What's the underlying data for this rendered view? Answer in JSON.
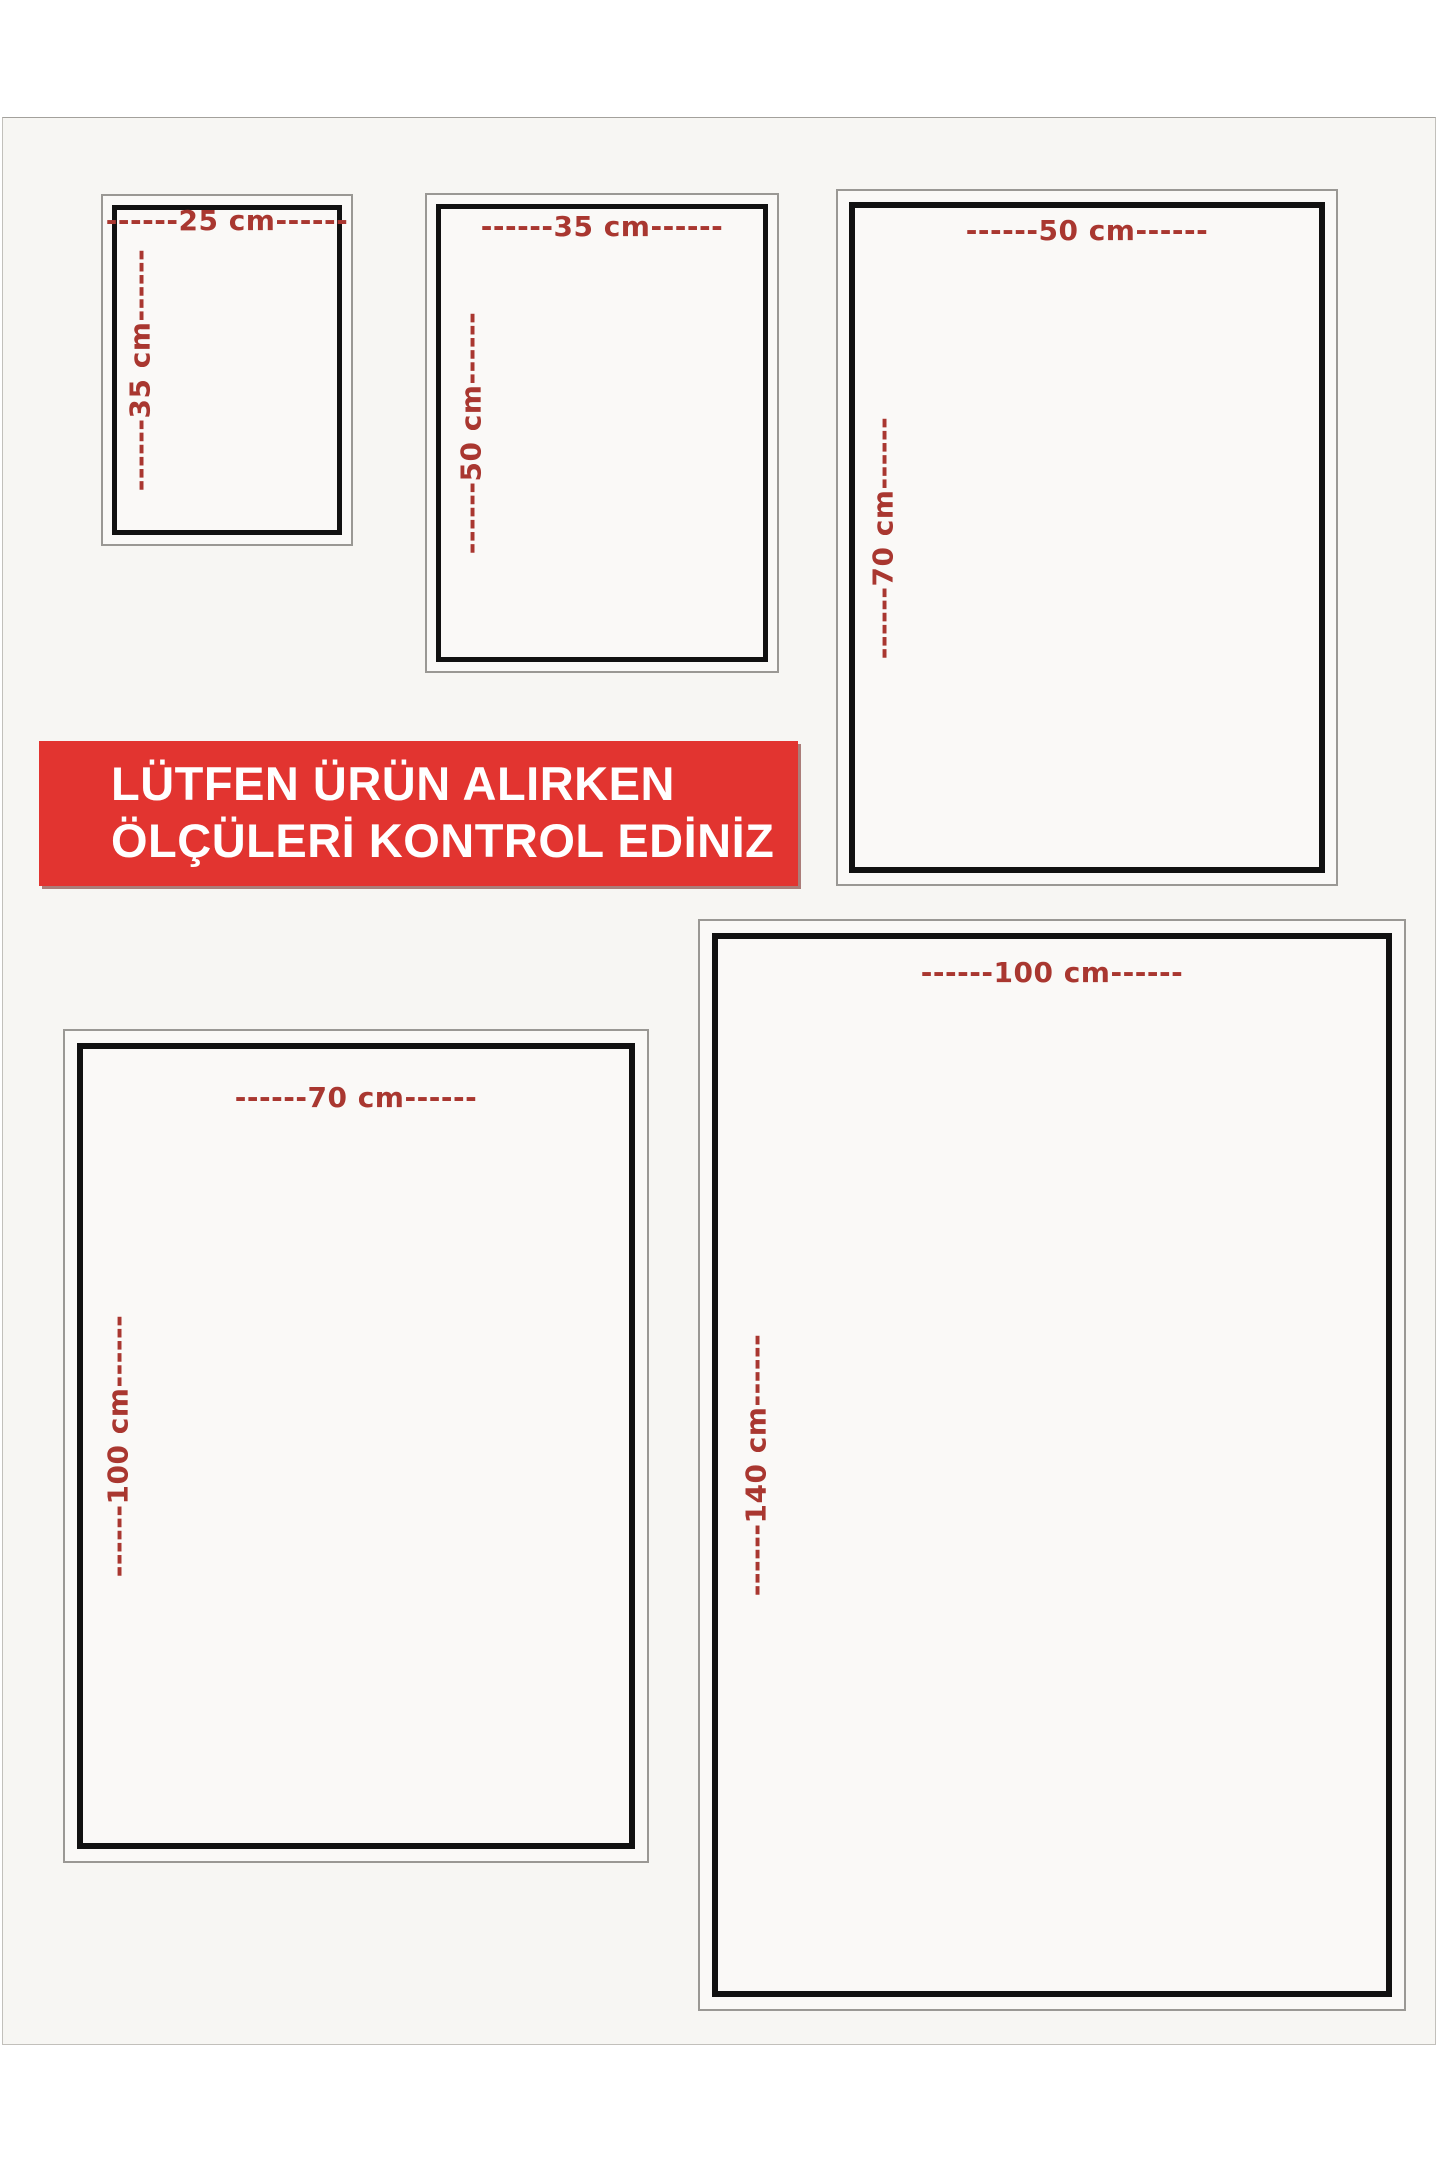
{
  "banner": {
    "line1": "LÜTFEN ÜRÜN ALIRKEN",
    "line2": "ÖLÇÜLERİ KONTROL EDİNİZ",
    "bg_color": "#e23430",
    "text_color": "#ffffff"
  },
  "frames": [
    {
      "name": "25x35",
      "width_cm": 25,
      "height_cm": 35,
      "top_label": "------25 cm------",
      "side_label": "------35 cm------"
    },
    {
      "name": "35x50",
      "width_cm": 35,
      "height_cm": 50,
      "top_label": "------35 cm------",
      "side_label": "------50 cm------"
    },
    {
      "name": "50x70",
      "width_cm": 50,
      "height_cm": 70,
      "top_label": "------50 cm------",
      "side_label": "------70 cm------"
    },
    {
      "name": "70x100",
      "width_cm": 70,
      "height_cm": 100,
      "top_label": "------70 cm------",
      "side_label": "------100 cm------"
    },
    {
      "name": "100x140",
      "width_cm": 100,
      "height_cm": 140,
      "top_label": "------100 cm------",
      "side_label": "------140 cm------"
    }
  ],
  "colors": {
    "label_red": "#a93730",
    "banner_red": "#e23430",
    "frame_black": "#111111",
    "frame_gray": "#9a9894",
    "photo_bg": "#f7f6f3"
  }
}
